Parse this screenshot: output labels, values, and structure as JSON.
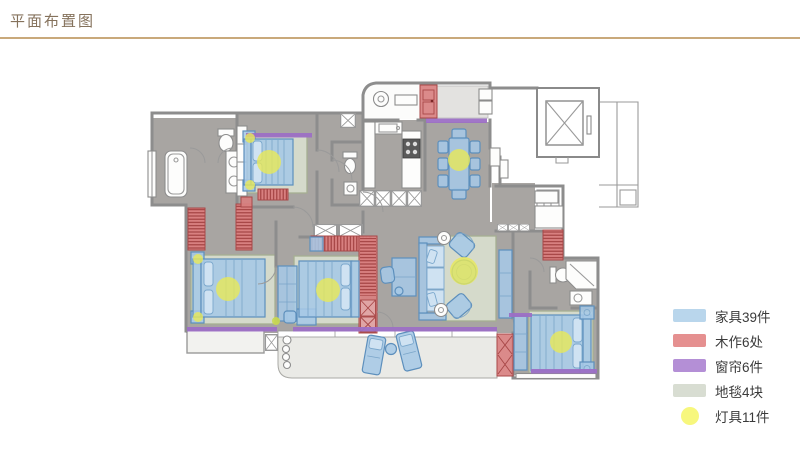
{
  "header": {
    "title": "平面布置图"
  },
  "legend": {
    "items": [
      {
        "key": "furniture",
        "label": "家具39件",
        "color": "#b9d6ec",
        "shape": "rect"
      },
      {
        "key": "woodwork",
        "label": "木作6处",
        "color": "#e59090",
        "shape": "rect"
      },
      {
        "key": "curtains",
        "label": "窗帘6件",
        "color": "#b48fd6",
        "shape": "rect"
      },
      {
        "key": "carpets",
        "label": "地毯4块",
        "color": "#d8ddd2",
        "shape": "rect"
      },
      {
        "key": "lights",
        "label": "灯具11件",
        "color": "#f7f77d",
        "shape": "circle"
      }
    ]
  },
  "plan": {
    "colors": {
      "floor": "#a8a5a2",
      "wall": "#8d8d8d",
      "furniture": "#a6c8e6",
      "woodwork": "#d88080",
      "curtain": "#9c6fc5",
      "carpet": "#d7dccd",
      "light": "#e9e957",
      "balcony": "#eaeae6"
    }
  }
}
